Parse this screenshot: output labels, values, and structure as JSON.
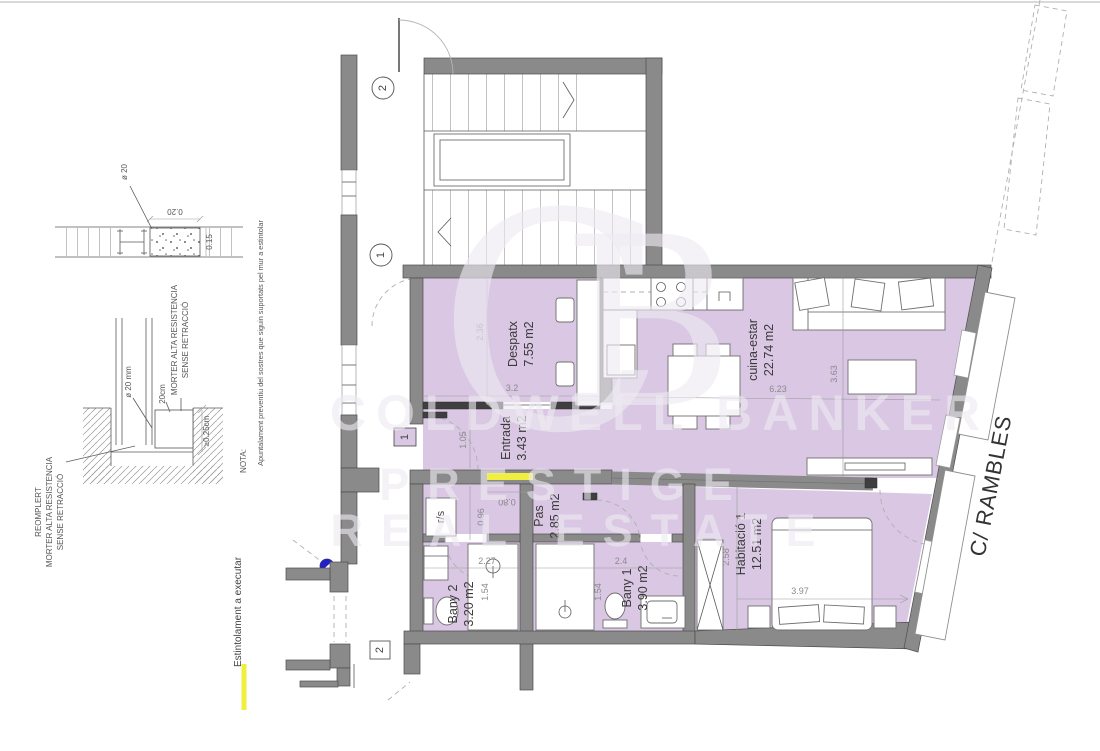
{
  "rooms": [
    {
      "name": "Despatx",
      "area": "7.55 m2"
    },
    {
      "name": "Entrada",
      "area": "3.43 m2"
    },
    {
      "name": "cuina-estar",
      "area": "22.74 m2"
    },
    {
      "name": "Pas",
      "area": "2.85 m2"
    },
    {
      "name": "Bany 2",
      "area": "3.20 m2"
    },
    {
      "name": "Bany 1",
      "area": "3.90 m2"
    },
    {
      "name": "Habitació 1",
      "area": "12.51 m2"
    }
  ],
  "dims": {
    "despatx_w": "2.36",
    "despatx_d": "3.2",
    "entrada_h": "1.05",
    "pas_h": "0.96",
    "pas_door": "0.80",
    "bany2_w": "2.27",
    "bany2_h": "1.54",
    "bany1_w": "2.4",
    "bany1_h": "1.54",
    "hab_h": "2.58",
    "hab_w": "3.97",
    "cuina_w": "6.23",
    "cuina_h": "3.63",
    "det_w": "0.20",
    "det_h": "0.15",
    "det_phi": "ø 20",
    "det_phi_mm": "ø 20 mm",
    "det_20cm": "20cm",
    "det_min": "≥0.25cm"
  },
  "markers": {
    "stair_upper": "2",
    "stair_lower": "1",
    "apartment_door": "1",
    "service_door": "2"
  },
  "fixtures": {
    "washer": "r/s"
  },
  "street": {
    "name": "C/ RAMBLES"
  },
  "legend": {
    "label": "Estintolament a executar"
  },
  "nota": {
    "title": "NOTA:",
    "text": "Apuntalament preventiu del sostres que siguin suportats pel mur a estintolar"
  },
  "details": {
    "reomplert1": "REOMPLERT",
    "reomplert2": "MORTER ALTA RESISTENCIA",
    "reomplert3": "SENSE RETRACCIÓ",
    "morter1": "MORTER ALTA RESISTENCIA",
    "morter2": "SENSE RETRACCIÓ"
  },
  "watermark": {
    "brand": "COLDWELL BANKER",
    "line2": "PRESTIGE",
    "line3": "REAL ESTATE",
    "mono_c": "C",
    "mono_b": "B"
  },
  "colors": {
    "room_fill": "#d9c7e3",
    "wall": "#8a8a8a",
    "highlight": "#f0ee3f",
    "marker_blue": "#2121c8"
  }
}
